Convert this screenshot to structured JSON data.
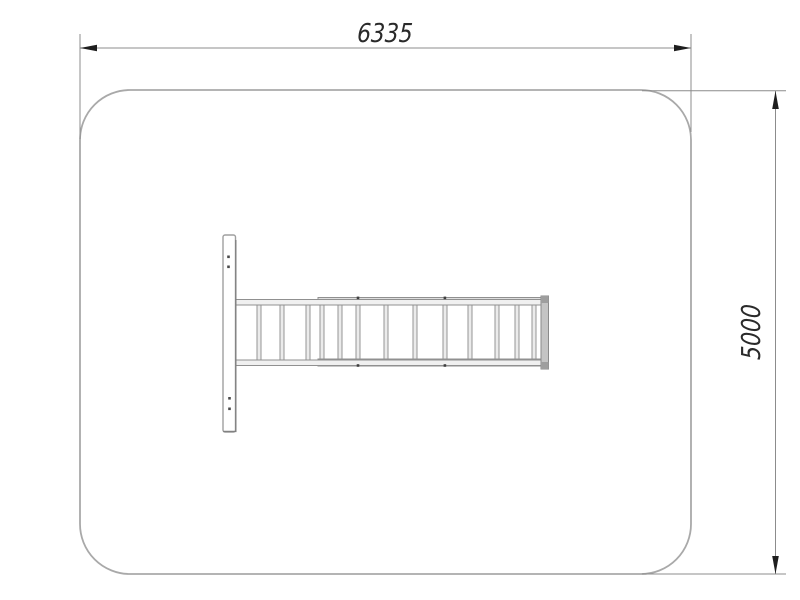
{
  "drawing": {
    "view": "top-view-plan",
    "dimensions": {
      "top": {
        "label": "6335"
      },
      "right": {
        "label": "5000"
      }
    },
    "equipment": {
      "parts": [
        "wall-post",
        "horizontal-ladder",
        "ladder-end-bar"
      ]
    },
    "colors": {
      "background": "#ffffff",
      "area_outline": "#a9a9a9",
      "dimension_line": "#8c8c8c",
      "dimension_text": "#2a2a2a",
      "arrowhead": "#1e1e1e",
      "equipment_stroke": "#949494",
      "equipment_fill": "#eeeeee"
    }
  }
}
